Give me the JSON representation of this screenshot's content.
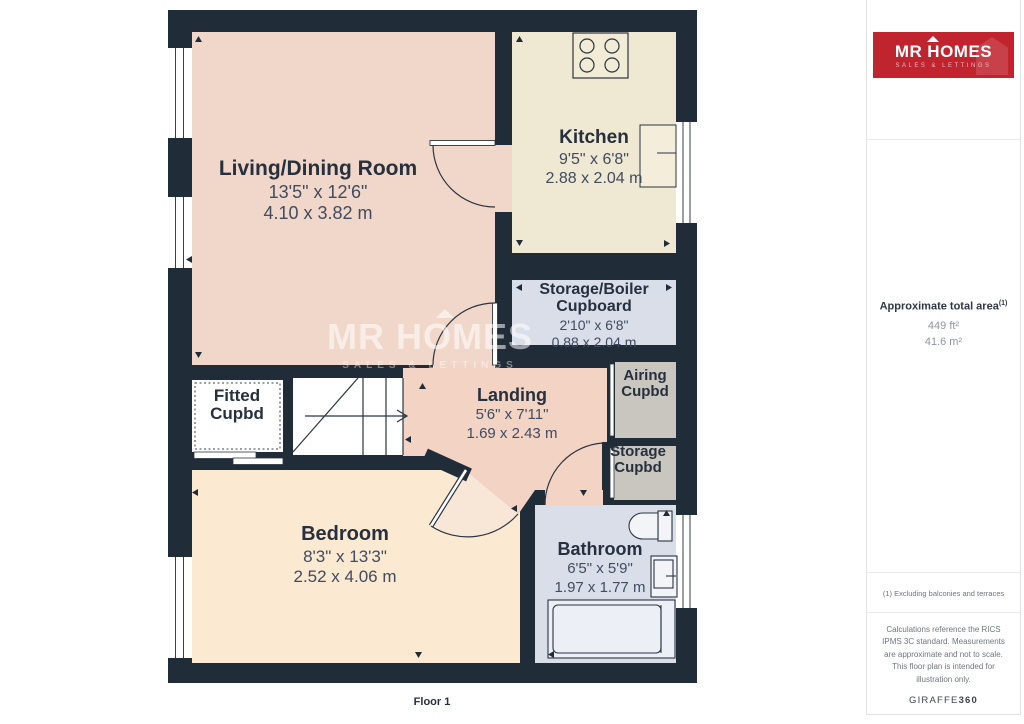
{
  "floorplan": {
    "floor_label": "Floor 1",
    "watermark": {
      "brand": "MR HOMES",
      "tagline": "SALES & LETTINGS"
    },
    "rooms": [
      {
        "name": "Living/Dining Room",
        "dims_imperial": "13'5\" x 12'6\"",
        "dims_metric": "4.10 x 3.82 m"
      },
      {
        "name": "Kitchen",
        "dims_imperial": "9'5\" x 6'8\"",
        "dims_metric": "2.88 x 2.04 m"
      },
      {
        "name": "Storage/Boiler Cupboard",
        "dims_imperial": "2'10\" x 6'8\"",
        "dims_metric": "0.88 x 2.04 m"
      },
      {
        "name": "Fitted Cupbd"
      },
      {
        "name": "Landing",
        "dims_imperial": "5'6\" x 7'11\"",
        "dims_metric": "1.69 x 2.43 m"
      },
      {
        "name": "Airing Cupbd"
      },
      {
        "name": "Storage Cupbd"
      },
      {
        "name": "Bedroom",
        "dims_imperial": "8'3\" x 13'3\"",
        "dims_metric": "2.52 x 4.06 m"
      },
      {
        "name": "Bathroom",
        "dims_imperial": "6'5\" x 5'9\"",
        "dims_metric": "1.97 x 1.77 m"
      }
    ]
  },
  "sidebar": {
    "logo": {
      "brand_mr": "MR",
      "brand_homes": "HOMES",
      "tagline": "SALES & LETTINGS"
    },
    "area": {
      "title": "Approximate total area",
      "superscript": "(1)",
      "value_imperial": "449 ft²",
      "value_metric": "41.6 m²"
    },
    "footnote": "(1) Excluding balconies and terraces",
    "disclaimer": "Calculations reference the RICS IPMS 3C standard. Measurements are approximate and not to scale. This floor plan is intended for illustration only.",
    "provider_name": "GIRAFFE",
    "provider_suffix": "360"
  },
  "colors": {
    "wall": "#212C39",
    "living": "#F1D7C9",
    "kitchen": "#EFE8D2",
    "utility_blue": "#DADEE9",
    "landing": "#F2D3C4",
    "bedroom": "#FBE9D1",
    "cupboard_grey": "#C8C6BF",
    "brand_red": "#C0242F"
  }
}
